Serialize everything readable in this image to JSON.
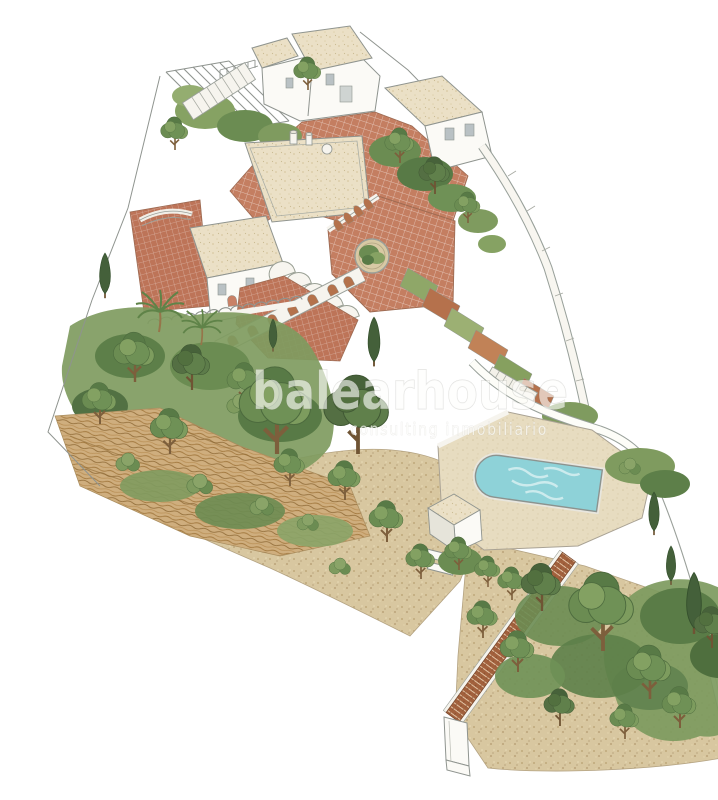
{
  "page": {
    "background": "#ffffff",
    "description": "Isometric watercolor site-plan illustration of a Mediterranean hillside villa estate with terracotta roofs, tiled courtyards, terraced gardens, pine trees and an arched swimming pool"
  },
  "watermark": {
    "brand": "balearhouse",
    "tagline": "consulting inmobiliario"
  },
  "palette": {
    "background": "#ffffff",
    "courtyard_tile": "#c47e61",
    "roof_tile": "#bd7458",
    "flat_roof": "#ebe0c6",
    "wall_white": "#fbfaf6",
    "wall_shade": "#e6e4da",
    "outline_gray": "#8f948f",
    "sand": "#d8c7a0",
    "dry_brush": "#cfae7e",
    "pool_water": "#8ed2d8",
    "pool_deck": "#e7dcc0",
    "stair_brick": "#a2613d",
    "tree_dark": "#546f43",
    "tree_mid": "#6b8c52",
    "tree_light": "#83a162"
  }
}
